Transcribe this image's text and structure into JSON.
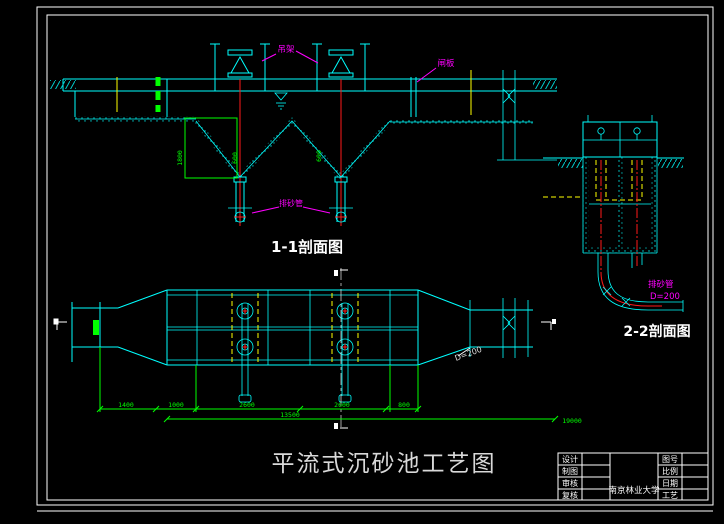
{
  "sheet": {
    "main_title": "平流式沉砂池工艺图",
    "colors": {
      "line": "#00ffff",
      "dimension": "#00ff00",
      "label": "#ff00ff",
      "pipe_centerline": "#ff1a1a",
      "level_line": "#ffff00",
      "frame": "#ffffff"
    }
  },
  "section11": {
    "title": "1-1剖面图",
    "labels": {
      "hoist": "吊架",
      "gate": "闸板",
      "grit_pipe": "排砂管"
    },
    "dims": {
      "depth": "1800",
      "left_wall": "600",
      "right_wall": "600"
    }
  },
  "section22": {
    "title": "2-2剖面图",
    "labels": {
      "pipe_name": "排砂管",
      "pipe_size": "D=200"
    }
  },
  "plan": {
    "labels": {
      "outlet_pipe": "D=200"
    },
    "dims": {
      "segments": [
        "1400",
        "1000",
        "2600",
        "2600",
        "800"
      ],
      "subtotal": "13500",
      "overall": "19000"
    }
  },
  "title_block": {
    "left_rows": [
      {
        "label": "设计",
        "value": ""
      },
      {
        "label": "制图",
        "value": ""
      },
      {
        "label": "审核",
        "value": ""
      },
      {
        "label": "复核",
        "value": ""
      }
    ],
    "right_rows": [
      {
        "label": "图号",
        "value": ""
      },
      {
        "label": "比例",
        "value": ""
      },
      {
        "label": "日期",
        "value": ""
      },
      {
        "label": "工艺",
        "value": ""
      }
    ],
    "organization": "南京林业大学"
  }
}
